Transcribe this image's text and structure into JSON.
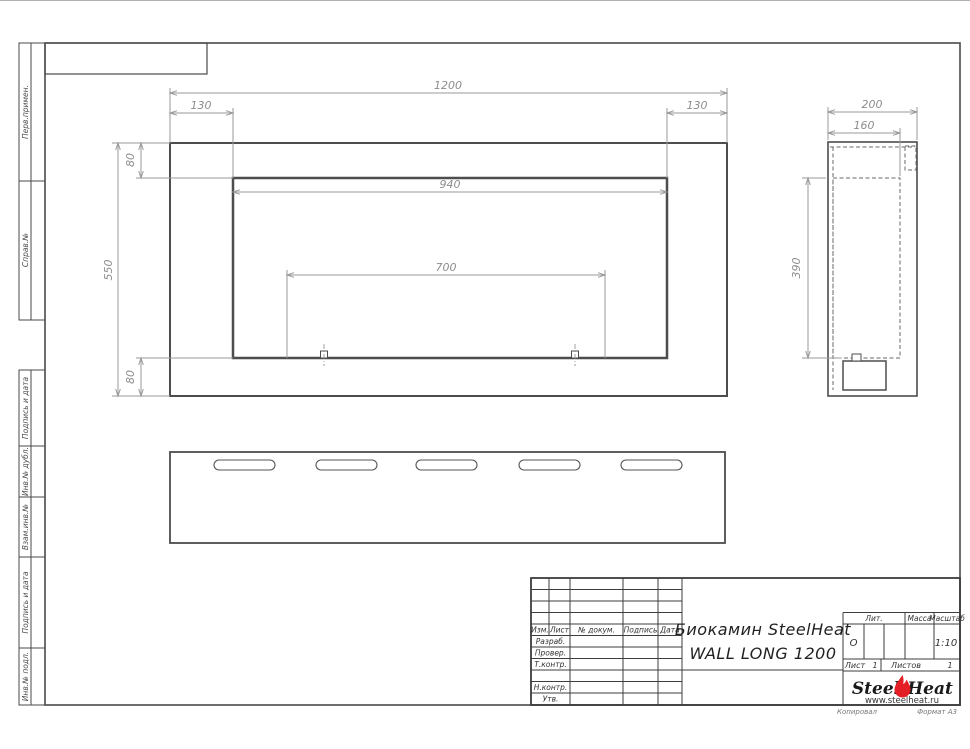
{
  "margin": {
    "perv": "Перв.примен.",
    "sprav": "Справ.№",
    "podpis1": "Подпись и дата",
    "dubl": "Инв.№ дубл.",
    "vzam": "Взам.инв.№",
    "podpis2": "Подпись и дата",
    "podl": "Инв.№ подл."
  },
  "views": {
    "front": {
      "dim_width": "1200",
      "dim_left_offset": "130",
      "dim_right_offset": "130",
      "dim_opening_width": "940",
      "dim_burner_span": "700",
      "dim_height": "550",
      "dim_top_flange": "80",
      "dim_bottom_flange": "80"
    },
    "side": {
      "dim_depth": "200",
      "dim_inner_depth": "160",
      "dim_opening_height": "390"
    }
  },
  "title_block": {
    "rev_header": {
      "izm": "Изм.",
      "list": "Лист",
      "doc": "№ докум.",
      "podpis": "Подпись",
      "data": "Дата"
    },
    "sign_rows": {
      "razrab": "Разраб.",
      "prover": "Провер.",
      "tkontr": "Т.контр.",
      "nkontr": "Н.контр.",
      "utv": "Утв."
    },
    "doc_name_line1": "Биокамин SteelHeat",
    "doc_name_line2": "WALL LONG 1200",
    "lit": {
      "label": "Лит.",
      "value": "О"
    },
    "massa": {
      "label": "Масса"
    },
    "masshtab": {
      "label": "Масштаб",
      "value": "1:10"
    },
    "list": {
      "label": "Лист",
      "value": "1"
    },
    "listov": {
      "label": "Листов",
      "value": "1"
    },
    "brand": {
      "name_part1": "Steel",
      "name_part2": "Heat",
      "website": "www.steelheat.ru"
    }
  },
  "footer": {
    "kopiroval": "Копировал",
    "format": "Формат А3"
  },
  "colors": {
    "object_line": "#4d4d4d",
    "dim_line": "#9a9a9a",
    "dim_text": "#8c8c8c",
    "flame_red": "#e31e24",
    "logo_text": "#1a1a1a"
  }
}
